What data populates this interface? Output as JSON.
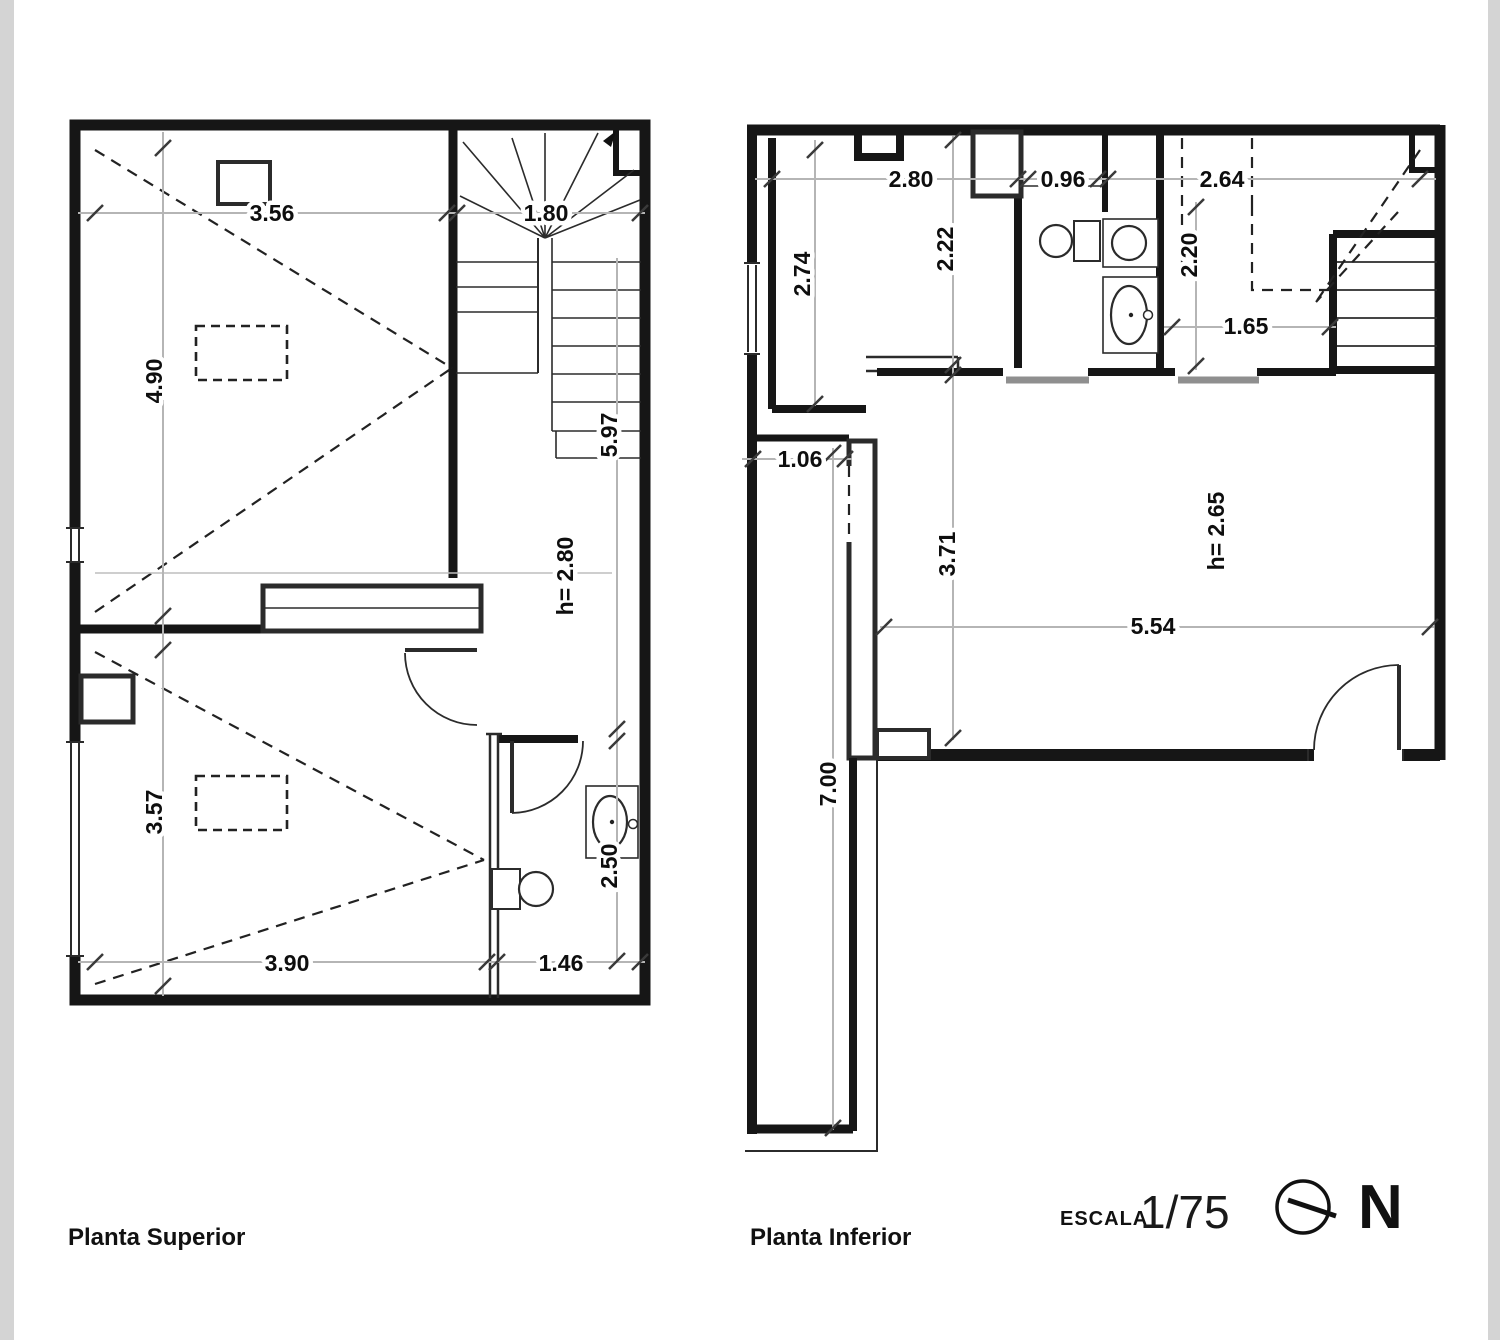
{
  "page": {
    "superior": {
      "title": "Planta Superior",
      "dims": {
        "top_width": "3.56",
        "stair_width": "1.80",
        "upper_height": "4.90",
        "stair_run": "5.97",
        "ceiling": "h= 2.80",
        "lower_height": "3.57",
        "bath_depth": "2.50",
        "lower_width": "3.90",
        "bath_width": "1.46"
      }
    },
    "inferior": {
      "title": "Planta Inferior",
      "dims": {
        "kitchen_width": "2.80",
        "wc_width": "0.96",
        "bedroom_width": "2.64",
        "kitchen_depth": "2.74",
        "entry_depth": "2.22",
        "hall_depth": "2.20",
        "hall_width": "1.65",
        "terrace_width": "1.06",
        "living_depth": "3.71",
        "ceiling": "h= 2.65",
        "living_width": "5.54",
        "terrace_length": "7.00"
      }
    },
    "scale_label": "ESCALA",
    "scale_value": "1/75",
    "north_label": "N"
  }
}
